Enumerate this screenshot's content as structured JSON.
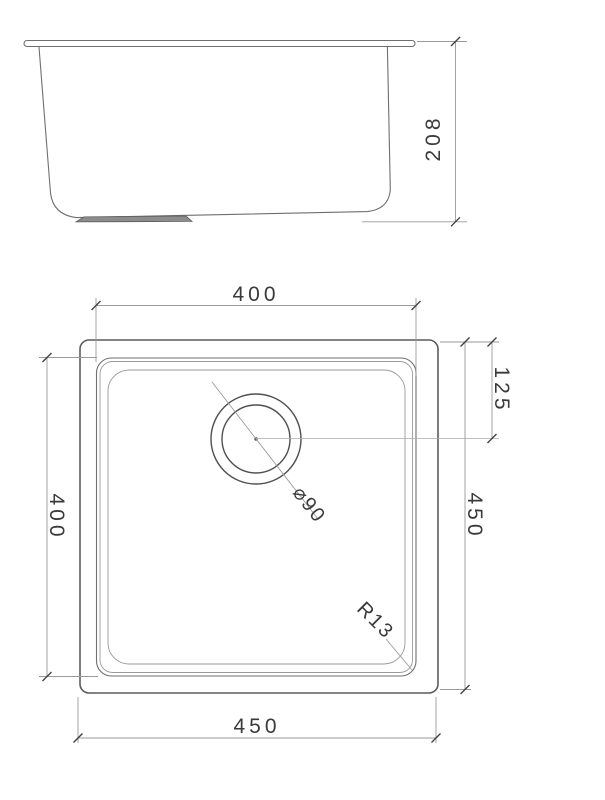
{
  "colors": {
    "background": "#ffffff",
    "line": "#6f6f6f",
    "dimension_line": "#9a9a9a",
    "text": "#3a3a3a"
  },
  "side_view": {
    "depth": "208"
  },
  "plan_view": {
    "inner_width": "400",
    "inner_length": "400",
    "outer_length": "450",
    "outer_width": "450",
    "drain_center_offset": "125",
    "drain_diameter": "⌀90",
    "corner_radius": "R13"
  }
}
